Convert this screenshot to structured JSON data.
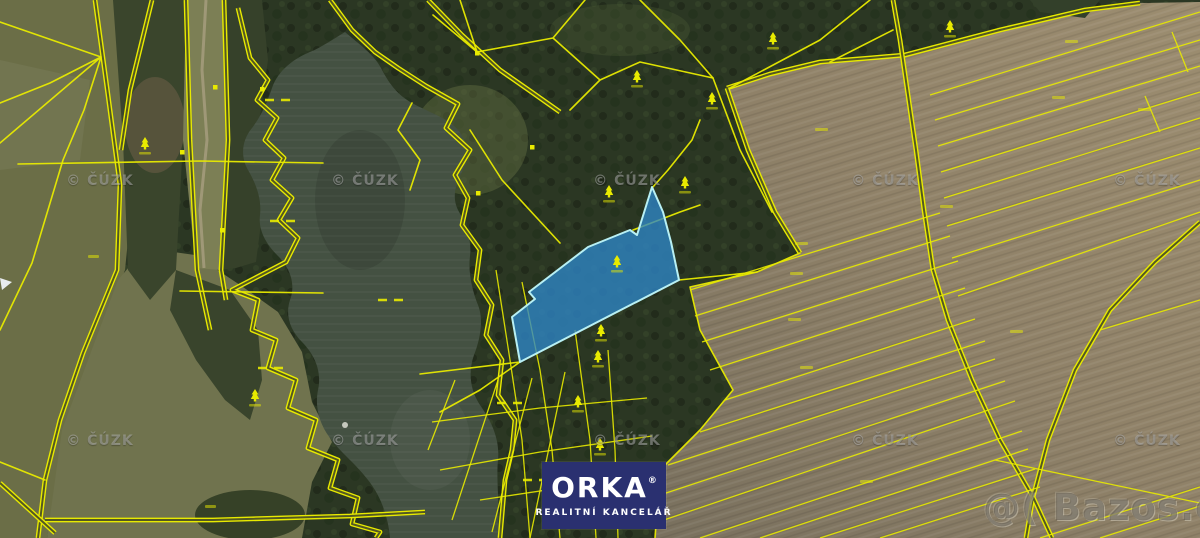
{
  "watermarks": {
    "cuzk_label": "© ČÚZK",
    "bazos_label": "@( Bazos.cz"
  },
  "logo": {
    "brand": "ORKA",
    "registered_mark": "®",
    "subtitle": "REALITNÍ KANCELÁŘ"
  },
  "map": {
    "kind": "cadastral parcel overlay on aerial imagery",
    "highlighted_parcel_present": true
  },
  "icons": {
    "tree_icon": "coniferous-tree-parcel-symbol",
    "building_icon": "small-square-building-symbol"
  },
  "colors": {
    "parcel_line": "#e8ea00",
    "highlight_fill": "#2e86c8",
    "highlight_border": "#b8f0f4",
    "water": "#445142",
    "forest": "#2b3723",
    "field_left": "#6b6e47",
    "field_right": "#8f8168",
    "logo_navy": "#2a3070",
    "watermark_gray": "rgba(180,180,180,0.52)",
    "bazos_gray": "rgba(88,82,72,0.55)"
  }
}
